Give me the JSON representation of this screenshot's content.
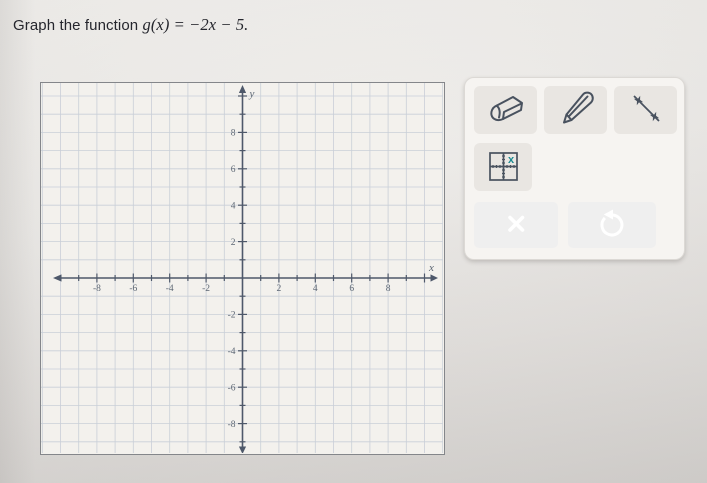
{
  "title": {
    "prefix": "Graph the function ",
    "math": "g(x) = −2x − 5."
  },
  "graph": {
    "x_axis_label": "x",
    "y_axis_label": "y",
    "tick_min": -10,
    "tick_max": 10,
    "tick_step": 1,
    "x_ticks_labeled": [
      -8,
      -6,
      -4,
      -2,
      2,
      4,
      6,
      8
    ],
    "y_ticks_labeled": [
      -8,
      -6,
      -4,
      -2,
      2,
      4,
      6,
      8
    ]
  },
  "toolbox": {
    "tools": [
      {
        "name": "eraser-tool"
      },
      {
        "name": "pencil-tool"
      },
      {
        "name": "line-tool"
      },
      {
        "name": "graph-tool"
      }
    ],
    "graph_tool_badge": "x"
  },
  "colors": {
    "teal_button": "#1b8a91",
    "icon_stroke": "#49525f",
    "axis": "#4e586a",
    "grid_line": "#c9cfd8",
    "tick_label": "#5c6673",
    "graph_paper": "#f3f1ed"
  }
}
